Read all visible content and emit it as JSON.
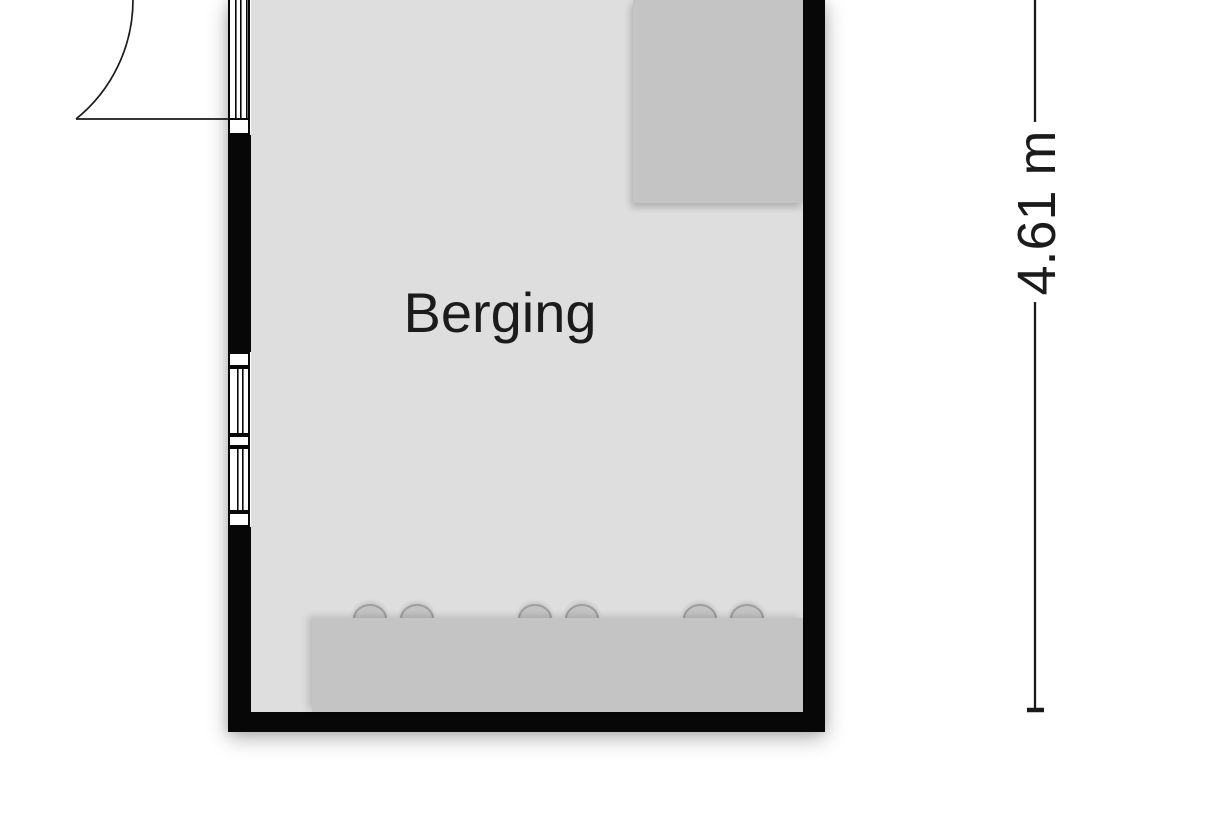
{
  "floorplan": {
    "room_label": "Berging",
    "dimension_label": "4.61 m",
    "dimension_axis": "vertical",
    "elements": {
      "door": "hinged door with quarter-circle swing arc, top of left wall",
      "windows": "two window panes with sills, middle of left wall",
      "storage_block": "grey rectangular unit, top-right corner",
      "counter": "grey workbench along bottom wall with six rounded knobs"
    },
    "colors": {
      "wall": "#070707",
      "floor": "#dedede",
      "furniture": "#c4c4c4",
      "line": "#1a1a1a",
      "text": "#1b1b1b",
      "background": "#ffffff"
    }
  }
}
